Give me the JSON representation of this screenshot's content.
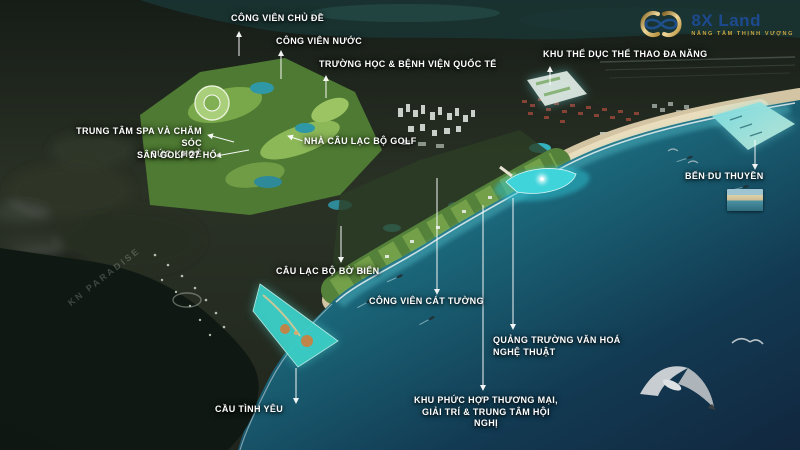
{
  "logo": {
    "brand": "8X Land",
    "tagline": "NÂNG TẦM THỊNH VƯỢNG"
  },
  "watermark": "KN PARADISE",
  "colors": {
    "label_text": "#ffffff",
    "brand_navy": "#1d4a8f",
    "brand_gold": "#cda53f",
    "highlight_cyan": "#3bccc4",
    "sea_deep": "#14304a",
    "sea_shallow": "#2f9fae",
    "sand": "#d6c8a6",
    "golf_green": "#6f9c44"
  },
  "callouts": [
    {
      "id": "theme-park",
      "text": "CÔNG VIÊN CHỦ ĐỀ"
    },
    {
      "id": "water-park",
      "text": "CÔNG VIÊN NƯỚC"
    },
    {
      "id": "school-hospital",
      "text": "TRƯỜNG HỌC & BỆNH VIỆN QUỐC TẾ"
    },
    {
      "id": "sports-complex",
      "text": "KHU THỂ DỤC THỂ THAO ĐA NĂNG"
    },
    {
      "id": "spa-center",
      "text": "TRUNG TÂM SPA VÀ CHĂM SÓC\nSỨC KHOẺ"
    },
    {
      "id": "golf-course",
      "text": "SÂN GOLF 27 HỐ"
    },
    {
      "id": "golf-clubhouse",
      "text": "NHÀ CÂU LẠC BỘ GOLF"
    },
    {
      "id": "marina",
      "text": "BẾN DU THUYỀN"
    },
    {
      "id": "beach-club",
      "text": "CÂU LẠC BỘ BỜ BIỂN"
    },
    {
      "id": "cat-tuong-park",
      "text": "CÔNG VIÊN CÁT TƯỜNG"
    },
    {
      "id": "culture-square",
      "text": "QUẢNG TRƯỜNG VĂN HOÁ\nNGHỆ THUẬT"
    },
    {
      "id": "commercial-complex",
      "text": "KHU PHỨC HỢP THƯƠNG MẠI,\nGIẢI TRÍ & TRUNG TÂM HỘI NGHỊ"
    },
    {
      "id": "love-bridge",
      "text": "CẦU TÌNH YÊU"
    }
  ]
}
